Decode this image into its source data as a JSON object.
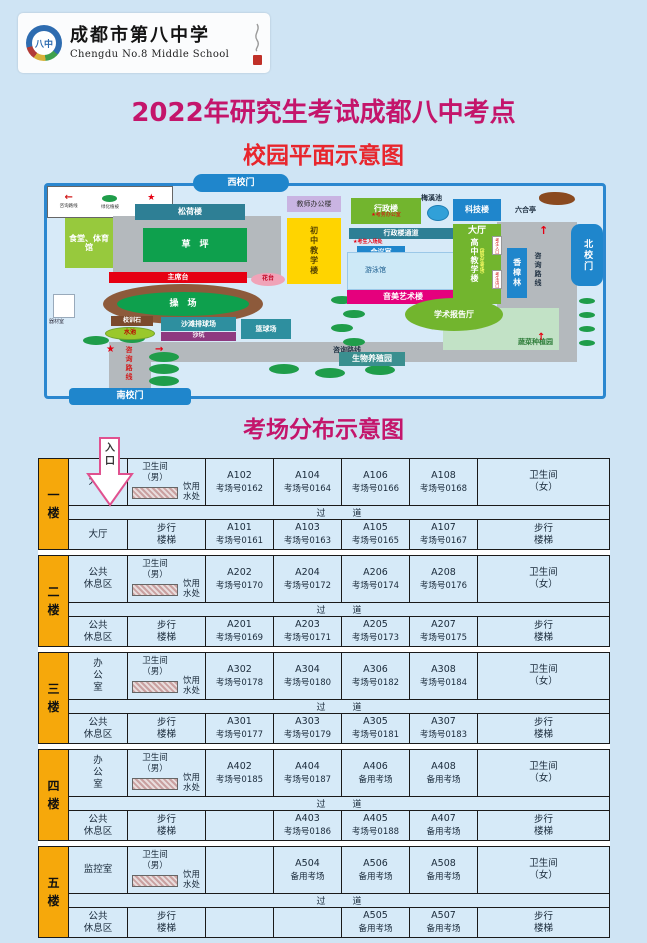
{
  "header": {
    "school_cn": "成都市第八中学",
    "school_en": "Chengdu No.8 Middle School",
    "emblem_text": "八中"
  },
  "titles": {
    "main": "2022年研究生考试成都八中考点",
    "campus": "校园平面示意图",
    "rooms": "考场分布示意图",
    "entrance": "入\n口"
  },
  "map": {
    "gates": {
      "west": "西校门",
      "north": "北校门",
      "south": "南校门"
    },
    "buildings": {
      "teacher_office": "教师办公楼",
      "songhe": "松荷楼",
      "canteen_gym": "食堂、体育馆",
      "lawn": "草　坪",
      "junior": "初中教学楼",
      "admin": "行政楼",
      "admin_note": "★考务办公室",
      "meixi_pond": "梅溪池",
      "tech": "科技楼",
      "liuhe": "六合亭",
      "admin_passage": "行政楼通道",
      "passage_note": "★考生入场处",
      "meeting": "会议室",
      "pool": "游泳馆",
      "art": "音美艺术楼",
      "hall": "大厅",
      "senior": "高中教学楼",
      "senior_note": "（研究生考场）",
      "gate_in_tag": "考生入口",
      "gate_out_tag": "考生出口",
      "camphor": "香樟林",
      "podium": "主席台",
      "flower_bed": "花台",
      "playground": "操　场",
      "motto_stone": "校训石",
      "pond": "水池",
      "beach_volleyball": "沙滩排球场",
      "sand_pit": "沙坑",
      "basketball": "篮球场",
      "equipment": "器材室",
      "lecture_hall": "学术报告厅",
      "vegetable_garden": "蔬菜种植园",
      "bio_garden": "生物养殖园"
    },
    "route_label": "咨询路线",
    "legend": {
      "route": "咨询路线",
      "greenery": "绿化植被",
      "info_desk": "咨询台所在位置"
    }
  },
  "board": {
    "corridor": "过　　　道",
    "toilet_m": "卫生间\n（男）",
    "toilet_f": "卫生间\n（女）",
    "water": "饮用\n水处",
    "stairs": "步行\n楼梯",
    "floors": [
      {
        "label": "一\n楼",
        "top_area": "大厅",
        "bottom_area": "大厅",
        "top_rooms": [
          {
            "code": "A102",
            "num": "考场号0162"
          },
          {
            "code": "A104",
            "num": "考场号0164"
          },
          {
            "code": "A106",
            "num": "考场号0166"
          },
          {
            "code": "A108",
            "num": "考场号0168"
          }
        ],
        "bottom_rooms": [
          {
            "code": "A101",
            "num": "考场号0161"
          },
          {
            "code": "A103",
            "num": "考场号0163"
          },
          {
            "code": "A105",
            "num": "考场号0165"
          },
          {
            "code": "A107",
            "num": "考场号0167"
          }
        ]
      },
      {
        "label": "二\n楼",
        "top_area": "公共\n休息区",
        "bottom_area": "公共\n休息区",
        "top_rooms": [
          {
            "code": "A202",
            "num": "考场号0170"
          },
          {
            "code": "A204",
            "num": "考场号0172"
          },
          {
            "code": "A206",
            "num": "考场号0174"
          },
          {
            "code": "A208",
            "num": "考场号0176"
          }
        ],
        "bottom_rooms": [
          {
            "code": "A201",
            "num": "考场号0169"
          },
          {
            "code": "A203",
            "num": "考场号0171"
          },
          {
            "code": "A205",
            "num": "考场号0173"
          },
          {
            "code": "A207",
            "num": "考场号0175"
          }
        ]
      },
      {
        "label": "三\n楼",
        "top_area": "办\n公\n室",
        "bottom_area": "公共\n休息区",
        "top_rooms": [
          {
            "code": "A302",
            "num": "考场号0178"
          },
          {
            "code": "A304",
            "num": "考场号0180"
          },
          {
            "code": "A306",
            "num": "考场号0182"
          },
          {
            "code": "A308",
            "num": "考场号0184"
          }
        ],
        "bottom_rooms": [
          {
            "code": "A301",
            "num": "考场号0177"
          },
          {
            "code": "A303",
            "num": "考场号0179"
          },
          {
            "code": "A305",
            "num": "考场号0181"
          },
          {
            "code": "A307",
            "num": "考场号0183"
          }
        ]
      },
      {
        "label": "四\n楼",
        "top_area": "办\n公\n室",
        "bottom_area": "公共\n休息区",
        "top_rooms": [
          {
            "code": "A402",
            "num": "考场号0185"
          },
          {
            "code": "A404",
            "num": "考场号0187"
          },
          {
            "code": "A406",
            "num": "备用考场"
          },
          {
            "code": "A408",
            "num": "备用考场"
          }
        ],
        "bottom_rooms": [
          {
            "code": "",
            "num": ""
          },
          {
            "code": "A403",
            "num": "考场号0186"
          },
          {
            "code": "A405",
            "num": "考场号0188"
          },
          {
            "code": "A407",
            "num": "备用考场"
          }
        ]
      },
      {
        "label": "五\n楼",
        "top_area": "监控室",
        "bottom_area": "公共\n休息区",
        "top_rooms": [
          {
            "code": "",
            "num": ""
          },
          {
            "code": "A504",
            "num": "备用考场"
          },
          {
            "code": "A506",
            "num": "备用考场"
          },
          {
            "code": "A508",
            "num": "备用考场"
          }
        ],
        "bottom_rooms": [
          {
            "code": "",
            "num": ""
          },
          {
            "code": "",
            "num": ""
          },
          {
            "code": "A505",
            "num": "备用考场"
          },
          {
            "code": "A507",
            "num": "备用考场"
          }
        ]
      }
    ]
  }
}
